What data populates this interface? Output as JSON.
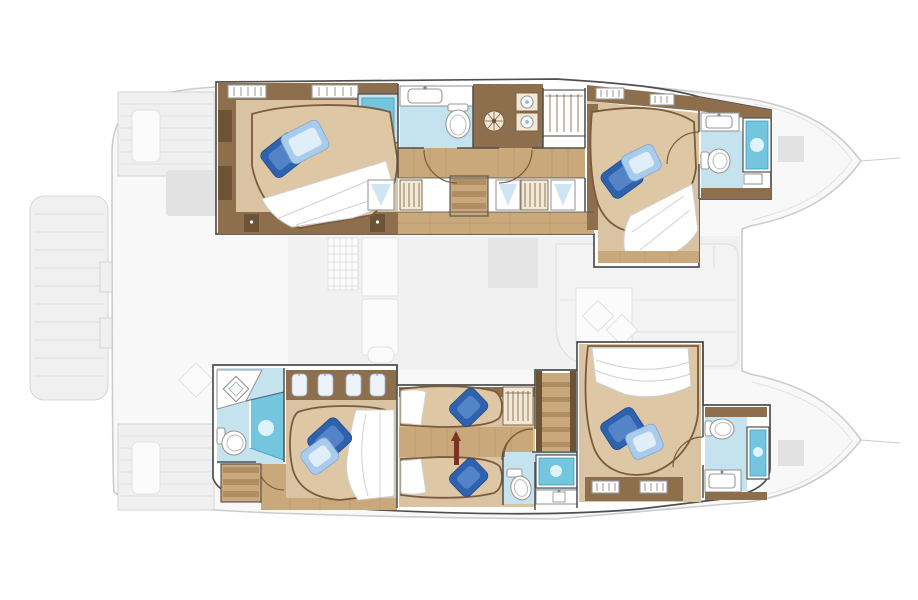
{
  "meta": {
    "title": "Catamaran lower deck floor plan",
    "view": "top-down plan",
    "orientation": "bow-right, stern-left",
    "style": "colored lower-deck accommodation over faded exterior deck silhouette"
  },
  "palette": {
    "deck_fill": "#f8f8f8",
    "deck_line": "#cccccc",
    "deck_faint": "#e0e0e0",
    "deck_soft": "#f0f0f0",
    "deck_block": "#e2e2e2",
    "wall": "#4f4f4f",
    "wood": "#8d6f4e",
    "wood_dark": "#6d5336",
    "wood_light": "#c9a87c",
    "plank": "#b08d63",
    "carpet": "#d9c3a2",
    "mattress": "#ddc7a5",
    "bed_line": "#7a5c3c",
    "duvet": "#ffffff",
    "duvet_line": "#d0d0d0",
    "bath_floor": "#c5e3ee",
    "shower_blue": "#74c6de",
    "shower_edge": "#3e9cc0",
    "shower_hi": "#def4fa",
    "cream": "#f1e8d6",
    "fixture_line": "#999999",
    "shirt": "#eef3f8",
    "curtain": "#cfe6f2",
    "ladder_red": "#7c3222",
    "pillow_dark": "#2e62ae",
    "pillow_dark_hi": "#6d9bd8",
    "pillow_light": "#a9cbec",
    "pillow_light_hi": "#eaf4fd"
  },
  "summary": {
    "cabins": 5,
    "double_berths": 4,
    "single_berths": 2,
    "wet_heads": 5,
    "stairways": 3
  },
  "exterior": {
    "features": [
      "stern-swim-platform",
      "aft-cockpit-benches",
      "salon-silhouette",
      "twin-bow-hulls"
    ]
  },
  "hulls": [
    {
      "id": "port-hull",
      "position": "top",
      "rooms": [
        {
          "name": "aft-cabin",
          "fixtures": [
            "double-berth",
            "navy-pillow",
            "light-blue-pillow",
            "corner-shower",
            "wardrobe",
            "side-cabinets",
            "nightstands"
          ]
        },
        {
          "name": "mid-bathroom",
          "fixtures": [
            "vanity-sink",
            "toilet"
          ]
        },
        {
          "name": "companionway",
          "fixtures": [
            "stairs",
            "two-doors",
            "vent-fan",
            "washer",
            "dryer",
            "hanging-locker",
            "hull-windows"
          ]
        },
        {
          "name": "forward-cabin",
          "fixtures": [
            "double-berth",
            "navy-pillow",
            "light-blue-pillow",
            "wardrobe"
          ]
        },
        {
          "name": "bow-bathroom",
          "fixtures": [
            "vanity-sink",
            "toilet",
            "shower",
            "bench"
          ]
        }
      ]
    },
    {
      "id": "starboard-hull",
      "position": "bottom",
      "rooms": [
        {
          "name": "aft-cabin-ensuite",
          "fixtures": [
            "corner-vanity",
            "diamond-sink",
            "toilet",
            "corner-shower",
            "double-berth",
            "navy-pillow",
            "light-blue-pillow",
            "wardrobe-shirts",
            "stairs"
          ]
        },
        {
          "name": "twin-cabin",
          "fixtures": [
            "single-berth-upper",
            "single-berth-lower",
            "navy-pillows",
            "ladder",
            "hanging-locker"
          ]
        },
        {
          "name": "center-stairway",
          "fixtures": [
            "stairs",
            "handrails"
          ]
        },
        {
          "name": "mid-bathroom",
          "fixtures": [
            "toilet",
            "shower",
            "vanity-counter"
          ]
        },
        {
          "name": "forward-cabin",
          "fixtures": [
            "double-berth",
            "navy-pillow",
            "light-blue-pillow",
            "wardrobe"
          ]
        },
        {
          "name": "bow-bathroom",
          "fixtures": [
            "toilet",
            "shower",
            "vanity-sink"
          ]
        }
      ]
    }
  ],
  "fixture_icons": {
    "toilet": "oval bowl with tank",
    "shower": "blue glass cubicle with light burst",
    "corner_shower": "angled glass cubicle",
    "sink": "counter basin",
    "washer_dryer": "stacked drum units",
    "vent_fan": "round louver",
    "wardrobe": "hanging rail marks",
    "stairs": "step treads",
    "door": "quarter-arc swing"
  }
}
